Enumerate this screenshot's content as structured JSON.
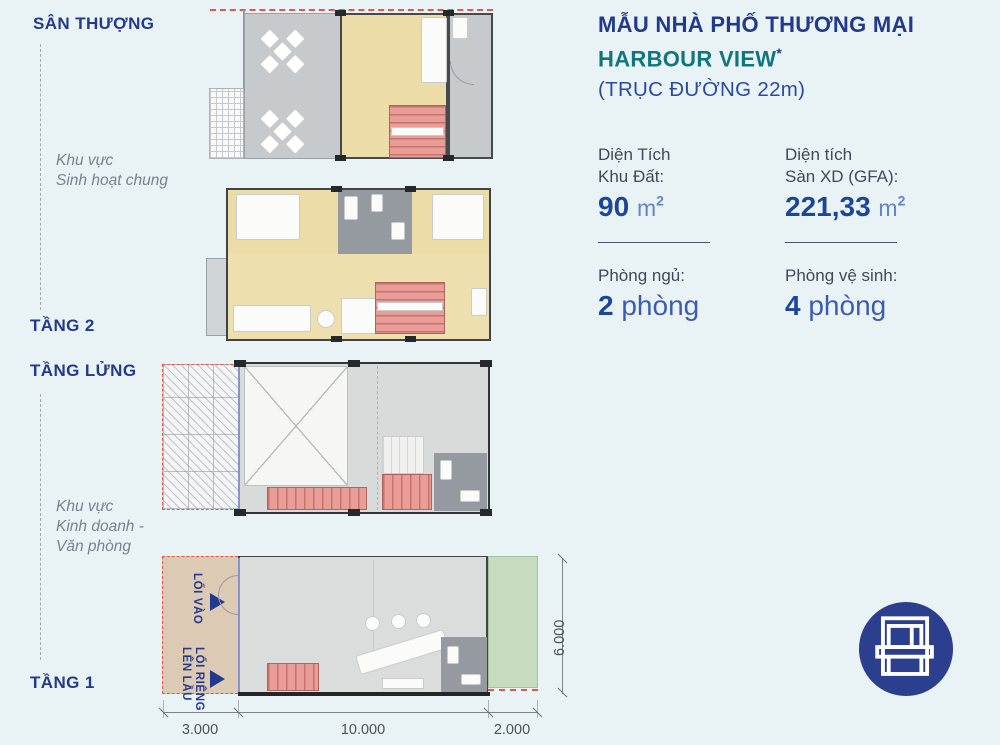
{
  "header": {
    "title": "MẪU NHÀ PHỐ THƯƠNG MẠI",
    "project": "HARBOUR VIEW",
    "asterisk": "*",
    "road": "(TRỤC ĐƯỜNG 22m)"
  },
  "stats": {
    "land_area": {
      "label1": "Diện Tích",
      "label2": "Khu Đất:",
      "value": "90",
      "unit": "m",
      "unit_sup": "2"
    },
    "gfa": {
      "label1": "Diện tích",
      "label2": "Sàn XD (GFA):",
      "value": "221,33",
      "unit": "m",
      "unit_sup": "2"
    },
    "bedrooms": {
      "label": "Phòng ngủ:",
      "value": "2",
      "unit": "phòng"
    },
    "bathrooms": {
      "label": "Phòng vệ sinh:",
      "value": "4",
      "unit": "phòng"
    }
  },
  "floors": {
    "rooftop_label": "SÂN THƯỢNG",
    "rooftop_zone_line1": "Khu vực",
    "rooftop_zone_line2": "Sinh hoạt chung",
    "floor2_label": "TẦNG 2",
    "mezzanine_label": "TẦNG LỬNG",
    "business_zone_line1": "Khu vực",
    "business_zone_line2": "Kinh doanh -",
    "business_zone_line3": "Văn phòng",
    "floor1_label": "TẦNG 1"
  },
  "plan": {
    "entrance_label": "LỐI VÀO",
    "private_entrance_line1": "LỐI RIÊNG",
    "private_entrance_line2": "LÊN LẦU"
  },
  "dimensions": {
    "left_width": "3.000",
    "main_width": "10.000",
    "right_width": "2.000",
    "depth": "6.000"
  },
  "colors": {
    "navy": "#233a8c",
    "teal": "#10767d",
    "value_blue": "#1c469c",
    "property_line_red": "#e2574c",
    "background": "#e9f3f5"
  }
}
